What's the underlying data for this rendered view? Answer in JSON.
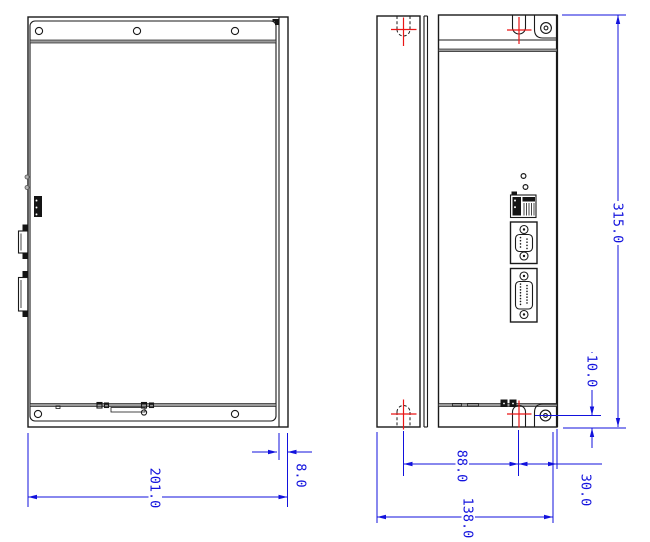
{
  "drawing": {
    "views": {
      "side_view": {
        "dims": {
          "overall_width": "201.0",
          "panel_lip": "8.0"
        }
      },
      "front_view": {
        "dims": {
          "overall_height": "315.0",
          "mount_hole_to_bottom": "10.0",
          "mount_hole_span": "88.0",
          "overall_width": "138.0",
          "slot_to_edge": "30.0"
        }
      }
    },
    "colors": {
      "outline": "#1a1a1a",
      "dimension": "#1212dd",
      "centerline": "#ea1515",
      "panel_band": "#9a9a9a",
      "background": "#ffffff"
    }
  }
}
